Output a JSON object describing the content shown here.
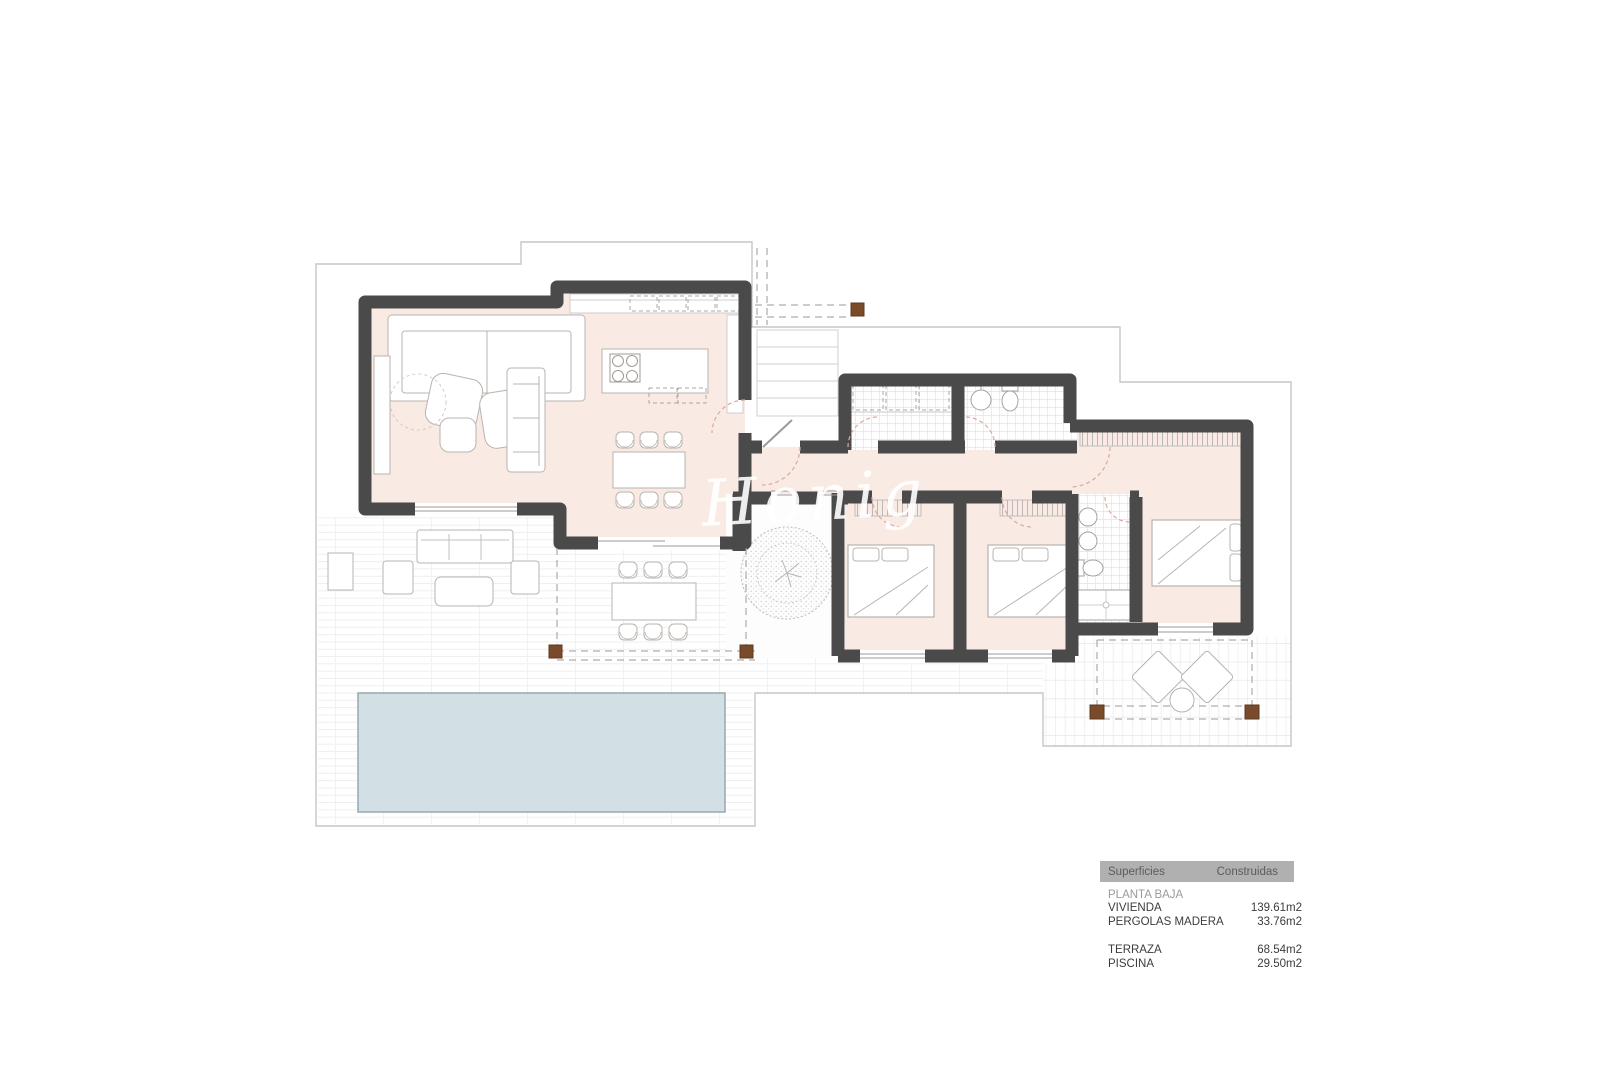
{
  "document": {
    "type": "architectural floor plan",
    "background": "#ffffff"
  },
  "watermark_text": "Honig",
  "legend": {
    "header_col1": "Superficies",
    "header_col2": "Construidas",
    "section_label": "PLANTA BAJA",
    "rows": [
      {
        "label": "VIVIENDA",
        "value": "139.61m2"
      },
      {
        "label": "PERGOLAS MADERA",
        "value": "33.76m2"
      },
      {
        "label": "TERRAZA",
        "value": "68.54m2"
      },
      {
        "label": "PISCINA",
        "value": "29.50m2"
      }
    ]
  },
  "colors": {
    "wall": "#4a4a4a",
    "interior_floor": "#f9eae3",
    "pool_fill": "#d2e0e6",
    "pool_border": "#96a8af",
    "pergola_post": "#7a4b2a",
    "site_boundary": "#c6c6c6",
    "terrace_grid": "#ececec",
    "bath_tile": "#e4e4e4",
    "furniture_line": "#b9b4b0",
    "door_arc": "#d9a9a0",
    "legend_header_bg": "#b0b0b0"
  }
}
